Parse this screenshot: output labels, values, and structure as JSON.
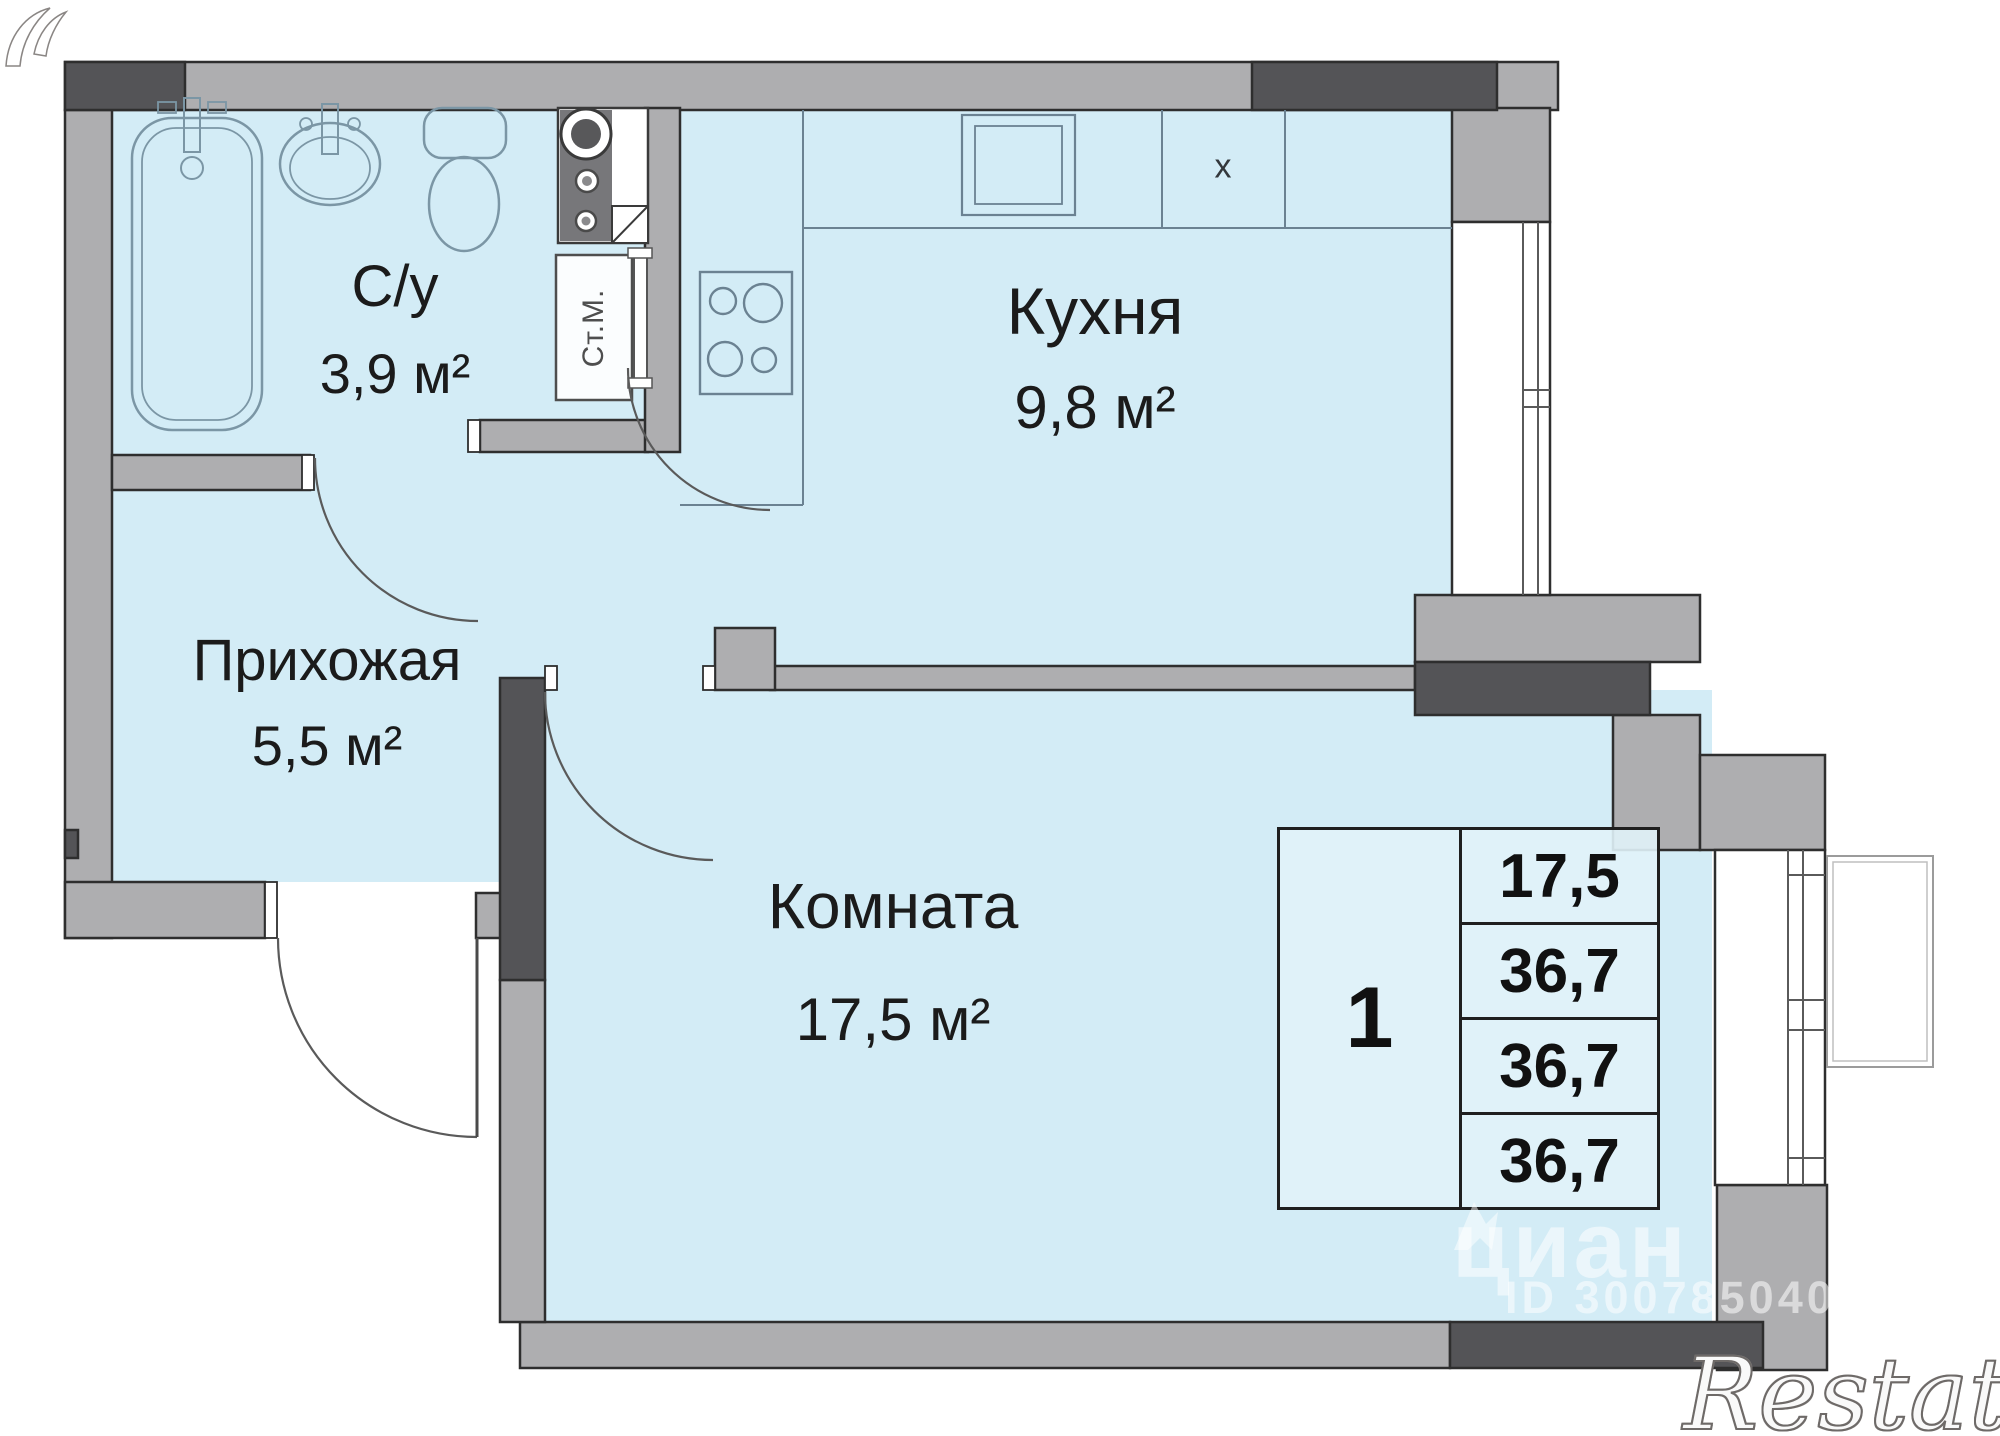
{
  "plan": {
    "rooms": [
      {
        "key": "bathroom",
        "name": "С/у",
        "area": "3,9 м²"
      },
      {
        "key": "kitchen",
        "name": "Кухня",
        "area": "9,8 м²"
      },
      {
        "key": "hallway",
        "name": "Прихожая",
        "area": "5,5 м²"
      },
      {
        "key": "living_room",
        "name": "Комната",
        "area": "17,5 м²"
      }
    ],
    "fixture_labels": {
      "washing_machine": "Ст.М.",
      "hob_marker": "х"
    },
    "info_table": {
      "rooms_count": "1",
      "areas": [
        "17,5",
        "36,7",
        "36,7",
        "36,7"
      ]
    }
  },
  "watermarks": {
    "cian_logo_text": "циан",
    "listing_id": "ID 300785040",
    "restate_logo_text": "Restate"
  },
  "colors": {
    "floor_fill": "#d3ecf6",
    "wall_light": "#aeaeb0",
    "wall_dark": "#545457",
    "outline": "#2e2e2e",
    "fixture_stroke": "#7b96a5",
    "label_text": "#1b1b1b",
    "watermark_white": "#ffffff"
  }
}
